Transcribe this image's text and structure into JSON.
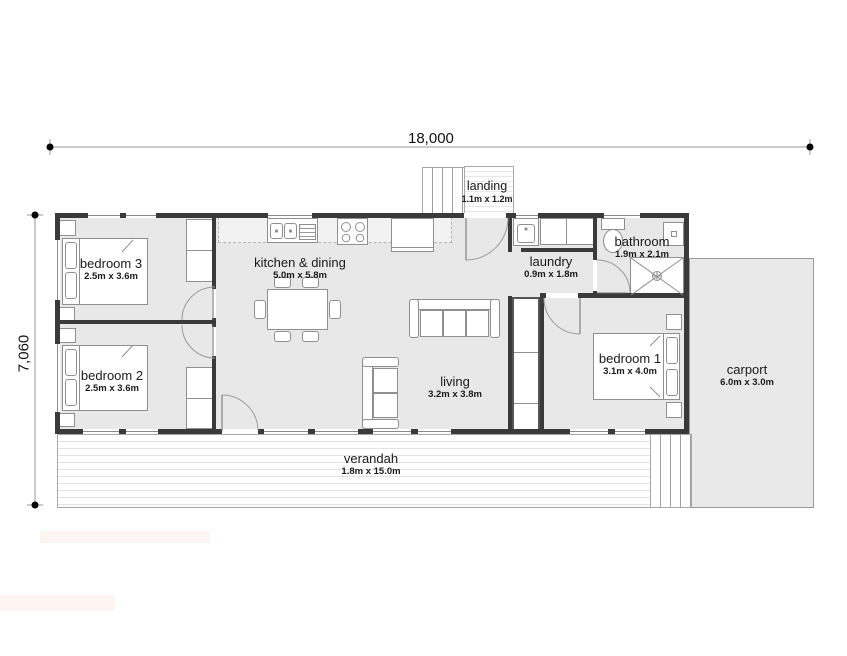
{
  "plan_title": "single storey house floor plan",
  "dimensions": {
    "width": "18,000",
    "height": "7,060"
  },
  "rooms": [
    {
      "name": "bedroom 3",
      "size": "2.5m x 3.6m"
    },
    {
      "name": "bedroom 2",
      "size": "2.5m x 3.6m"
    },
    {
      "name": "kitchen & dining",
      "size": "5.0m x 5.8m"
    },
    {
      "name": "living",
      "size": "3.2m x 3.8m"
    },
    {
      "name": "laundry",
      "size": "0.9m x 1.8m"
    },
    {
      "name": "bathroom",
      "size": "1.9m x 2.1m"
    },
    {
      "name": "bedroom 1",
      "size": "3.1m x 4.0m"
    },
    {
      "name": "carport",
      "size": "6.0m x 3.0m"
    },
    {
      "name": "verandah",
      "size": "1.8m x 15.0m"
    },
    {
      "name": "landing",
      "size": "1.1m x 1.2m"
    }
  ],
  "colors": {
    "wall": "#3a3a3a",
    "floor": "#e8e8e8",
    "furniture_outline": "#8f8f8f",
    "dimension_line": "#999999"
  }
}
